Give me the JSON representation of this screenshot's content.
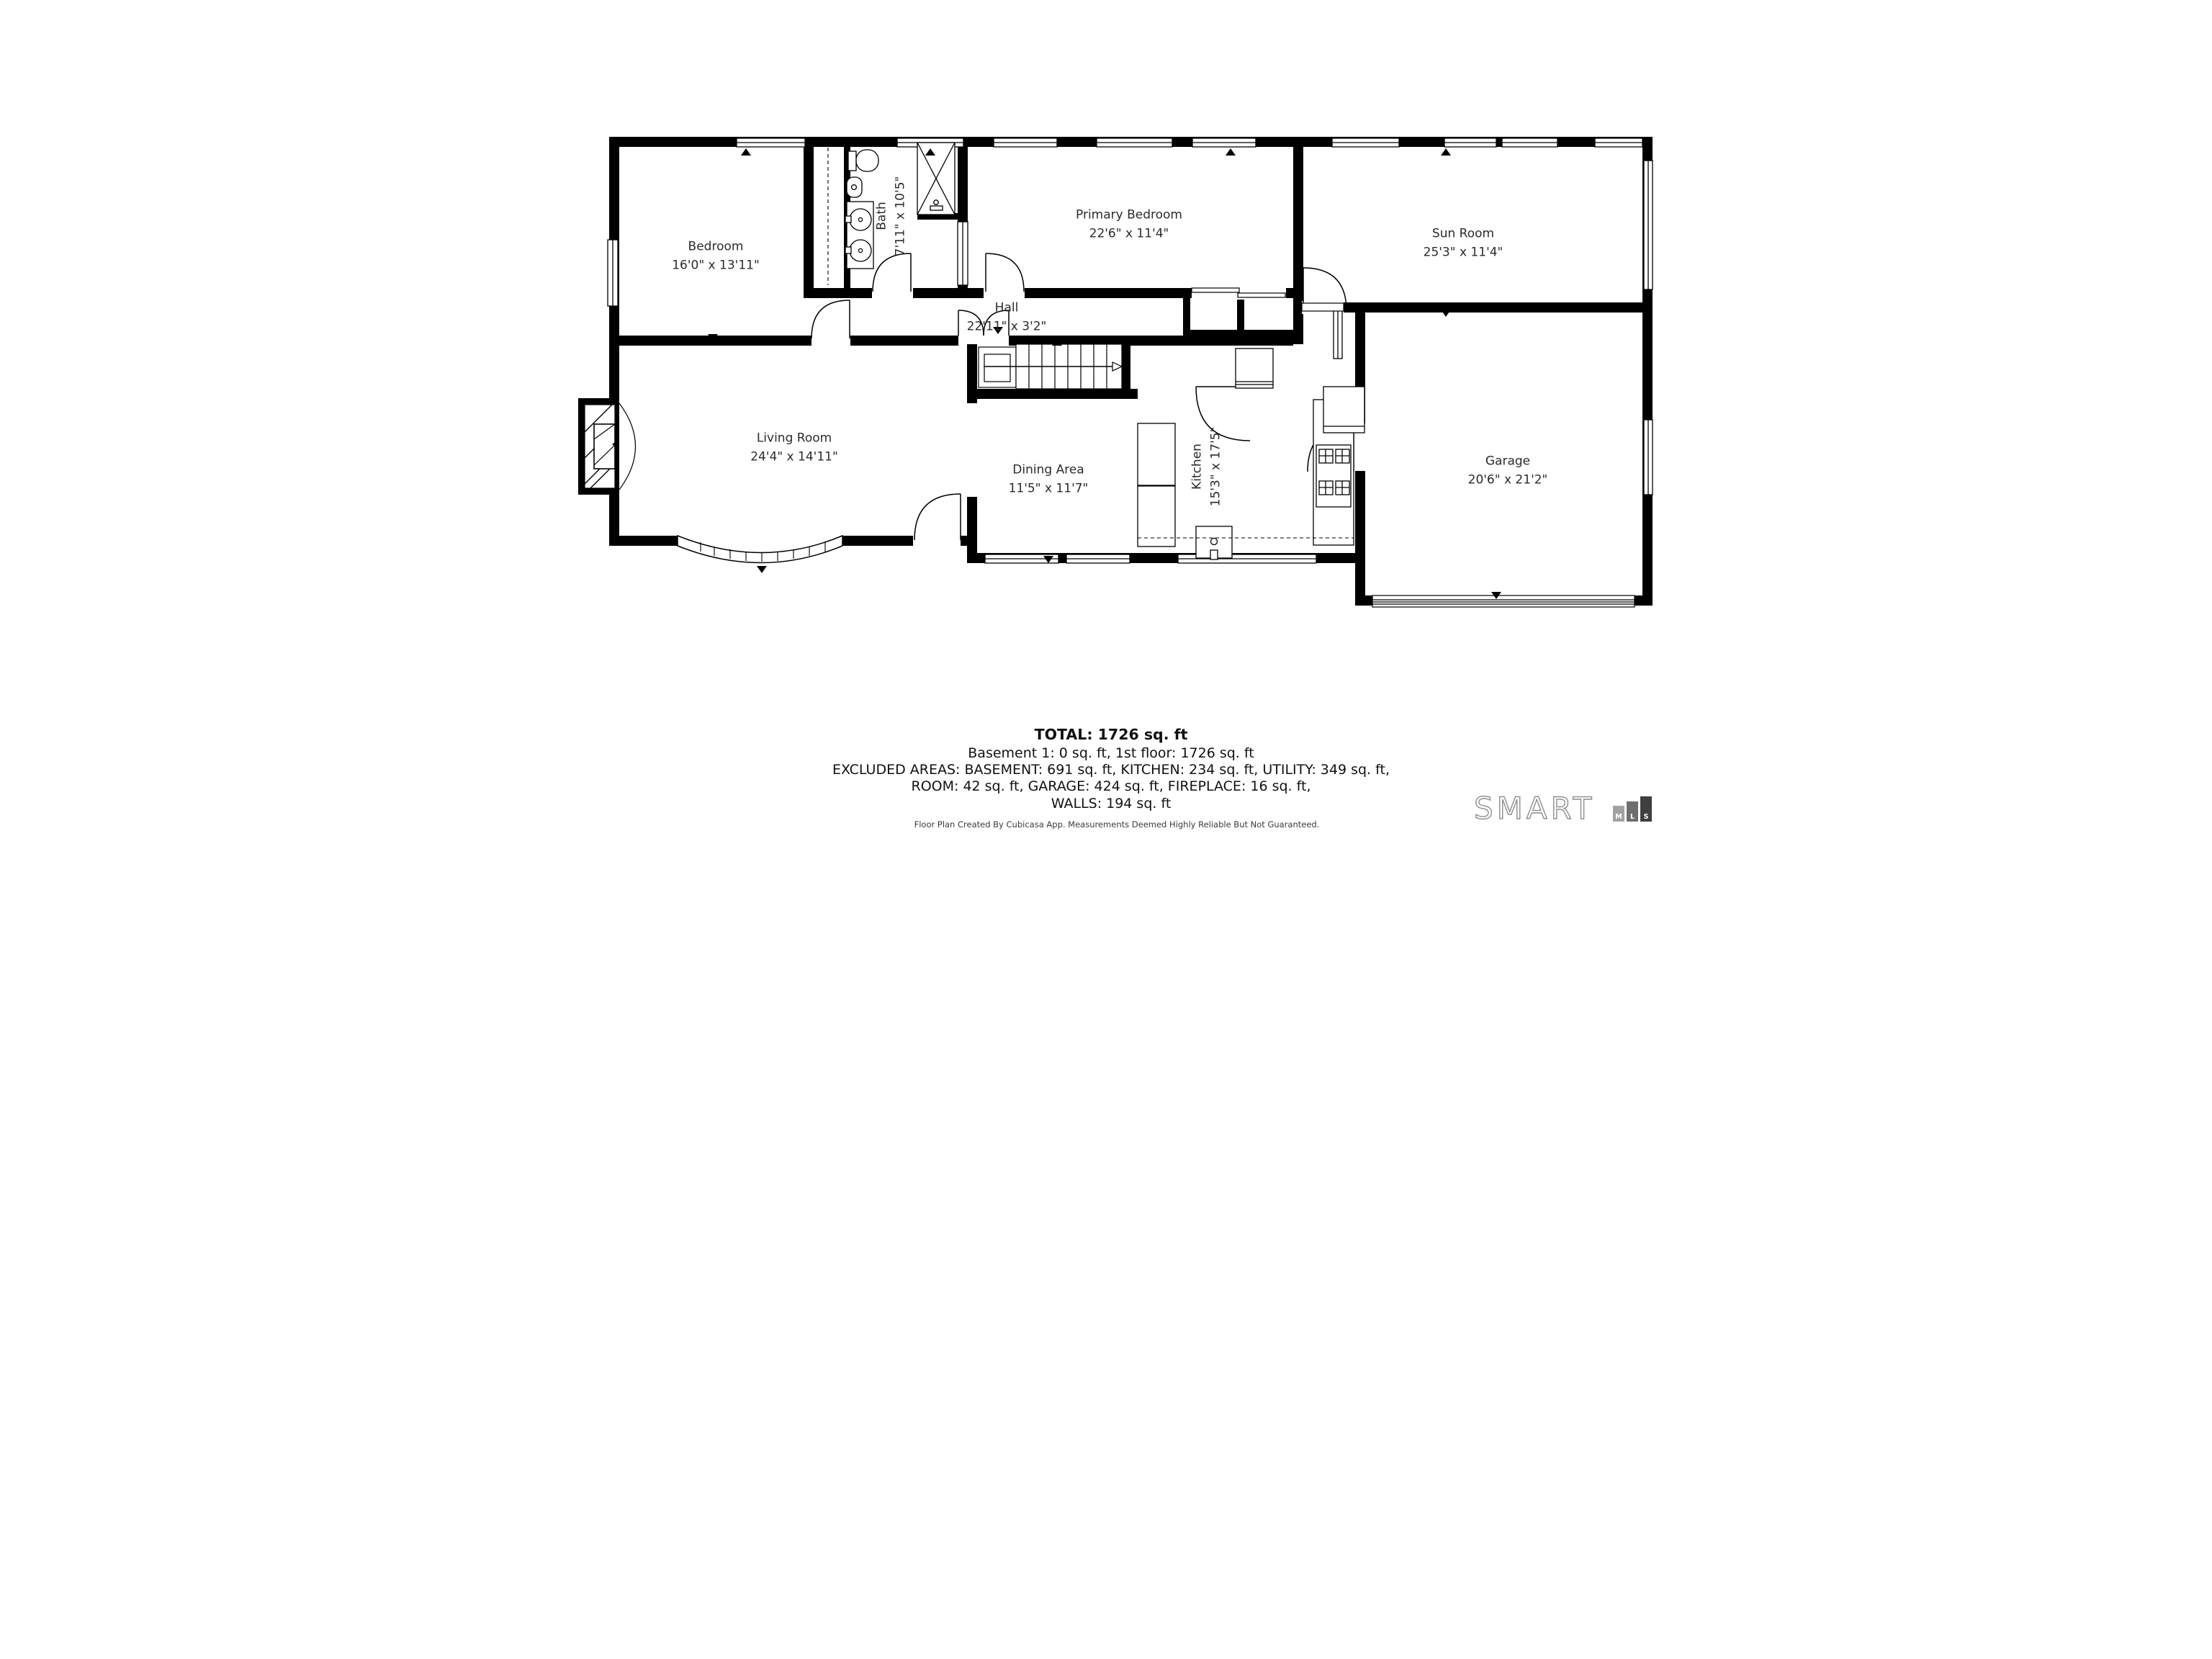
{
  "plan": {
    "rooms": [
      {
        "name": "Bedroom",
        "dims": "16'0\" x 13'11\""
      },
      {
        "name": "Bath",
        "dims": "7'11\" x 10'5\""
      },
      {
        "name": "Primary Bedroom",
        "dims": "22'6\" x 11'4\""
      },
      {
        "name": "Sun Room",
        "dims": "25'3\" x 11'4\""
      },
      {
        "name": "Hall",
        "dims": "22'11\" x 3'2\""
      },
      {
        "name": "Living Room",
        "dims": "24'4\" x 14'11\""
      },
      {
        "name": "Dining Area",
        "dims": "11'5\" x 11'7\""
      },
      {
        "name": "Kitchen",
        "dims": "15'3\" x 17'5\""
      },
      {
        "name": "Garage",
        "dims": "20'6\" x 21'2\""
      }
    ],
    "summary": {
      "total": "TOTAL: 1726 sq. ft",
      "line1": "Basement 1: 0 sq. ft, 1st floor: 1726 sq. ft",
      "line2": "EXCLUDED AREAS: BASEMENT: 691 sq. ft, KITCHEN: 234 sq. ft, UTILITY: 349 sq. ft,",
      "line3": "ROOM: 42 sq. ft, GARAGE: 424 sq. ft, FIREPLACE: 16 sq. ft,",
      "line4": "WALLS: 194 sq. ft"
    },
    "footer": "Floor Plan Created By Cubicasa App. Measurements Deemed Highly Reliable But Not Guaranteed.",
    "logo": {
      "text": "SMART",
      "mls": [
        "M",
        "L",
        "S"
      ]
    }
  },
  "colors": {
    "wall": "#000000",
    "line": "#1a1a1a",
    "label": "#2b2b2b"
  }
}
